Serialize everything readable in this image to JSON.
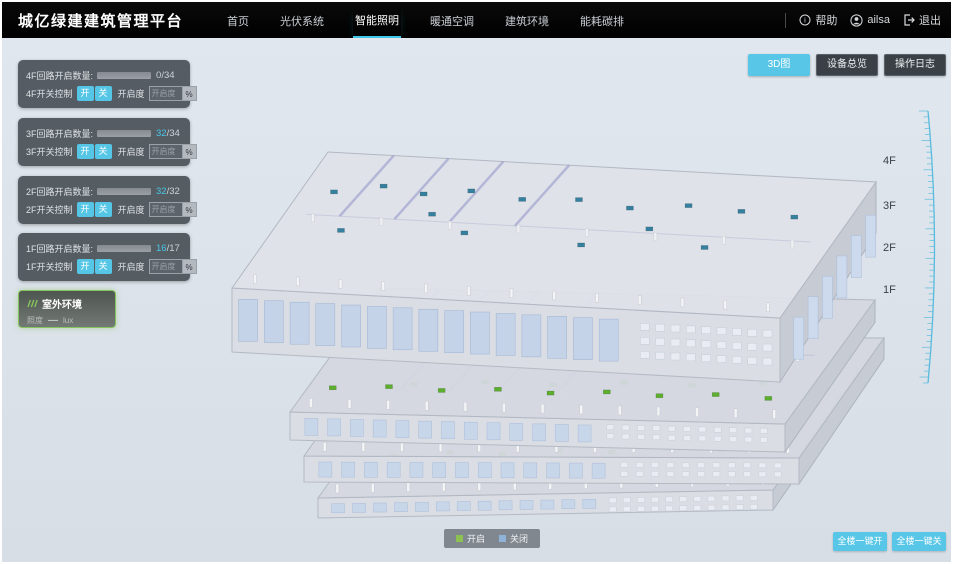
{
  "header": {
    "title": "城亿绿建建筑管理平台",
    "nav": [
      {
        "label": "首页",
        "active": false
      },
      {
        "label": "光伏系统",
        "active": false
      },
      {
        "label": "智能照明",
        "active": true
      },
      {
        "label": "暖通空调",
        "active": false
      },
      {
        "label": "建筑环境",
        "active": false
      },
      {
        "label": "能耗碳排",
        "active": false
      }
    ],
    "user": {
      "help": "帮助",
      "name": "ailsa",
      "logout": "退出"
    }
  },
  "view_buttons": [
    {
      "label": "3D图",
      "active": true
    },
    {
      "label": "设备总览",
      "active": false
    },
    {
      "label": "操作日志",
      "active": false
    }
  ],
  "floor_panels": [
    {
      "circuit_label": "4F回路开启数量:",
      "open": 0,
      "total": 34,
      "value_open": "0",
      "value_total": "/34",
      "switch_label": "4F开关控制",
      "on_label": "开",
      "off_label": "关",
      "dim_label": "开启度",
      "dim_placeholder": "开启度",
      "percent_label": "%"
    },
    {
      "circuit_label": "3F回路开启数量:",
      "open": 32,
      "total": 34,
      "value_open": "32",
      "value_total": "/34",
      "switch_label": "3F开关控制",
      "on_label": "开",
      "off_label": "关",
      "dim_label": "开启度",
      "dim_placeholder": "开启度",
      "percent_label": "%"
    },
    {
      "circuit_label": "2F回路开启数量:",
      "open": 32,
      "total": 32,
      "value_open": "32",
      "value_total": "/32",
      "switch_label": "2F开关控制",
      "on_label": "开",
      "off_label": "关",
      "dim_label": "开启度",
      "dim_placeholder": "开启度",
      "percent_label": "%"
    },
    {
      "circuit_label": "1F回路开启数量:",
      "open": 16,
      "total": 17,
      "value_open": "16",
      "value_total": "/17",
      "switch_label": "1F开关控制",
      "on_label": "开",
      "off_label": "关",
      "dim_label": "开启度",
      "dim_placeholder": "开启度",
      "percent_label": "%"
    }
  ],
  "outdoor_panel": {
    "title": "室外环境",
    "metric_label": "照度",
    "metric_value": "—",
    "metric_unit": "lux"
  },
  "floor_axis": [
    "4F",
    "3F",
    "2F",
    "1F"
  ],
  "legend": {
    "on_label": "开启",
    "on_color": "#8dc152",
    "off_label": "关闭",
    "off_color": "#8fb3d9"
  },
  "bottom_buttons": {
    "all_on": "全楼一键开",
    "all_off": "全楼一键关"
  },
  "colors": {
    "accent": "#58c6e6",
    "progress": "#3fc8ea",
    "header_bg": "#000000",
    "main_bg": "#dbe2e9"
  },
  "building": {
    "floors": [
      {
        "name": "4F",
        "dot_color": "#35809f",
        "dots": [
          [
            0.06,
            0.72
          ],
          [
            0.14,
            0.78
          ],
          [
            0.22,
            0.74
          ],
          [
            0.3,
            0.78
          ],
          [
            0.4,
            0.74
          ],
          [
            0.5,
            0.76
          ],
          [
            0.6,
            0.72
          ],
          [
            0.7,
            0.76
          ],
          [
            0.8,
            0.74
          ],
          [
            0.9,
            0.72
          ],
          [
            0.12,
            0.45
          ],
          [
            0.34,
            0.48
          ],
          [
            0.56,
            0.44
          ],
          [
            0.78,
            0.47
          ],
          [
            0.26,
            0.6
          ],
          [
            0.66,
            0.58
          ]
        ]
      },
      {
        "name": "3F",
        "dot_color": "#5cae2d",
        "dots": [
          [
            0.05,
            0.2
          ],
          [
            0.16,
            0.22
          ],
          [
            0.27,
            0.2
          ],
          [
            0.38,
            0.22
          ],
          [
            0.49,
            0.2
          ],
          [
            0.6,
            0.22
          ],
          [
            0.71,
            0.2
          ],
          [
            0.82,
            0.22
          ],
          [
            0.93,
            0.2
          ],
          [
            0.08,
            0.5
          ],
          [
            0.2,
            0.52
          ],
          [
            0.33,
            0.5
          ],
          [
            0.46,
            0.52
          ],
          [
            0.59,
            0.5
          ],
          [
            0.72,
            0.52
          ],
          [
            0.85,
            0.5
          ],
          [
            0.12,
            0.78
          ],
          [
            0.3,
            0.8
          ],
          [
            0.5,
            0.78
          ],
          [
            0.7,
            0.8
          ],
          [
            0.88,
            0.78
          ]
        ]
      },
      {
        "name": "2F",
        "dot_color": "#5cae2d",
        "dots": [
          [
            0.07,
            0.25
          ],
          [
            0.19,
            0.27
          ],
          [
            0.31,
            0.25
          ],
          [
            0.43,
            0.27
          ],
          [
            0.55,
            0.25
          ],
          [
            0.67,
            0.27
          ],
          [
            0.79,
            0.25
          ],
          [
            0.91,
            0.27
          ],
          [
            0.12,
            0.6
          ],
          [
            0.26,
            0.62
          ],
          [
            0.4,
            0.6
          ],
          [
            0.54,
            0.62
          ],
          [
            0.68,
            0.6
          ],
          [
            0.82,
            0.62
          ],
          [
            0.22,
            0.82
          ],
          [
            0.6,
            0.82
          ]
        ]
      },
      {
        "name": "1F",
        "dot_color": "#5cae2d",
        "dots": [
          [
            0.1,
            0.35
          ],
          [
            0.22,
            0.37
          ],
          [
            0.34,
            0.35
          ],
          [
            0.46,
            0.37
          ],
          [
            0.58,
            0.35
          ],
          [
            0.7,
            0.37
          ],
          [
            0.82,
            0.35
          ],
          [
            0.28,
            0.68
          ],
          [
            0.55,
            0.7
          ]
        ]
      }
    ]
  }
}
